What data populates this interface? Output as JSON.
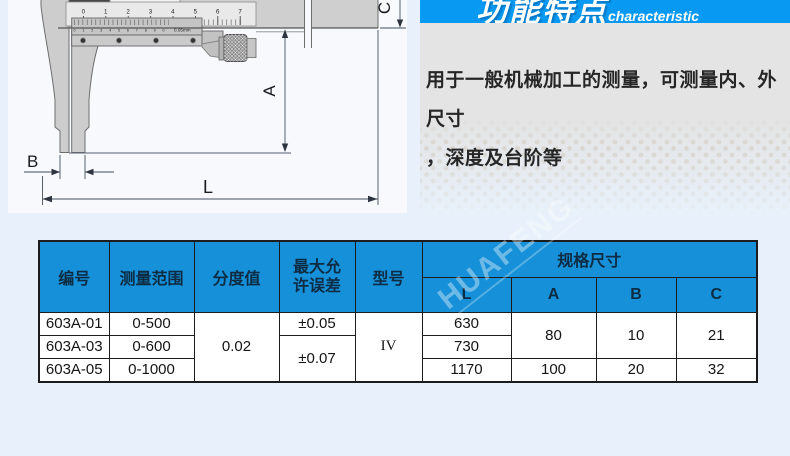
{
  "diagram": {
    "scale_numbers": [
      "0",
      "1",
      "2",
      "3",
      "4",
      "5",
      "6",
      "7"
    ],
    "vernier_digits": "01234567890",
    "vernier_precision": "0.05mm",
    "dims": {
      "a": "A",
      "b": "B",
      "c": "C",
      "l": "L"
    }
  },
  "features": {
    "title_zh": "功能特点",
    "title_en": "characteristic",
    "lines": [
      "用于一般机械加工的测量，可测量内、外尺寸",
      "，深度及台阶等"
    ]
  },
  "watermark": "HUAFENG",
  "table": {
    "headers": {
      "code": "编号",
      "range": "测量范围",
      "graduation": "分度值",
      "max_error": "最大允许误差",
      "model": "型号",
      "spec_group": "规格尺寸",
      "l": "L",
      "a": "A",
      "b": "B",
      "c": "C"
    },
    "merged": {
      "graduation": "0.02",
      "model": "IV",
      "error_rows23": "±0.07",
      "a_rows12": "80",
      "b_rows12": "10",
      "c_rows12": "21"
    },
    "rows": {
      "r1": {
        "code": "603A-01",
        "range": "0-500",
        "error": "±0.05",
        "l": "630"
      },
      "r2": {
        "code": "603A-03",
        "range": "0-600",
        "l": "730"
      },
      "r3": {
        "code": "603A-05",
        "range": "0-1000",
        "l": "1170",
        "a": "100",
        "b": "20",
        "c": "32"
      }
    }
  },
  "colors": {
    "banner_blue": "#0899f2",
    "table_header_blue": "#1690d8",
    "page_bg": "#e8f1fb",
    "feature_box_gray": "#e4e4e4",
    "table_header_text": "#0d2c44"
  }
}
